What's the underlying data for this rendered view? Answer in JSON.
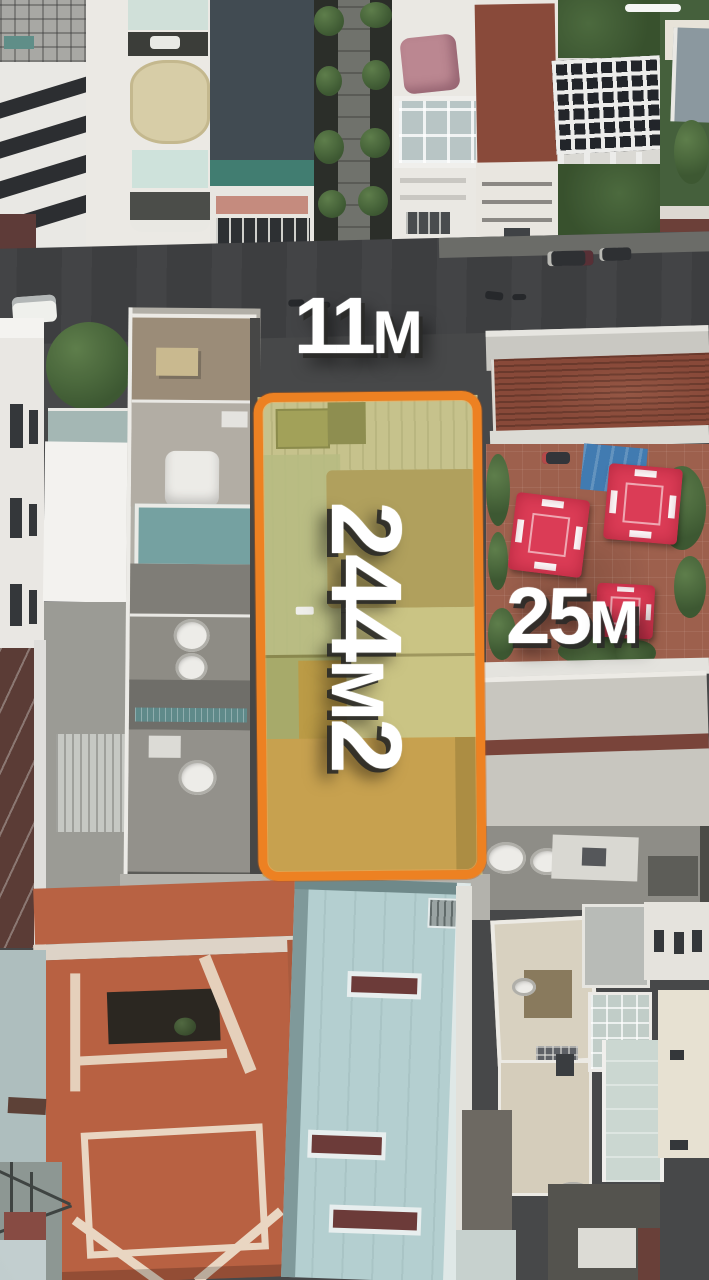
{
  "annotations": {
    "frontage_label": {
      "number": "11",
      "unit": "M"
    },
    "area_label": {
      "number": "244",
      "unit": "M",
      "superscript": "2"
    },
    "depth_label": {
      "number": "25",
      "unit": "M"
    }
  },
  "colors": {
    "plot_outline_orange": "#f2801c",
    "plot_overlay_yellow": "#c6c289",
    "label_text": "#ffffff",
    "road_asphalt": "#3d3e40",
    "terracotta_roof": "#bc6040",
    "rust_metal_roof": "#8b4837",
    "umbrella_red": "#e23a55",
    "cyan_building": "#b3cfd0",
    "tarp_blue": "#3e7bb4"
  }
}
